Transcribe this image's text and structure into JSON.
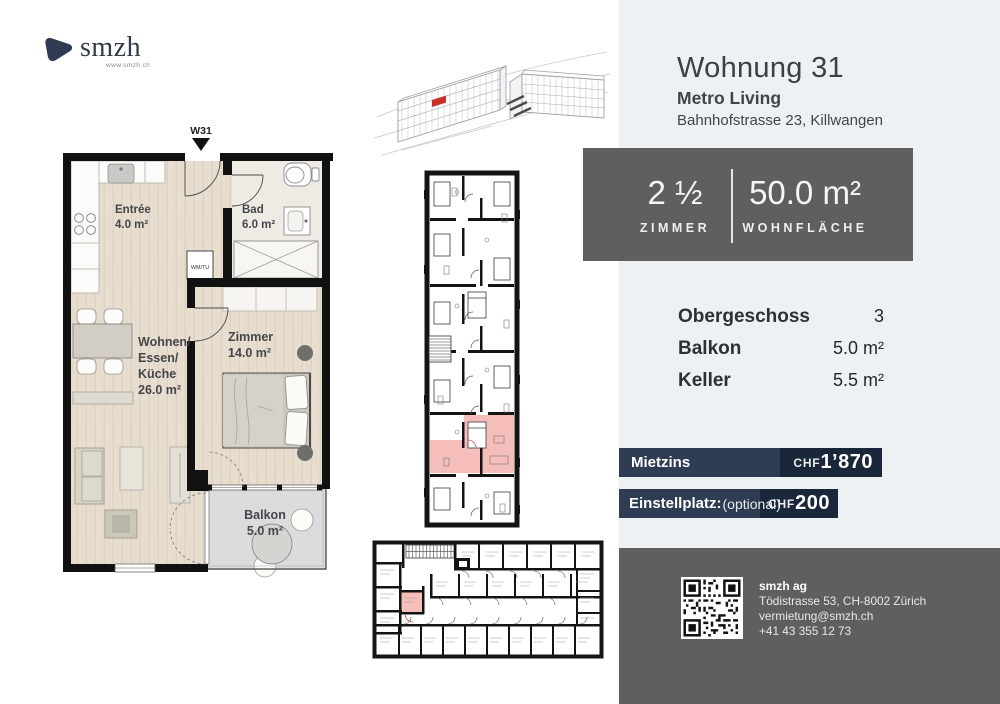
{
  "brand": {
    "name": "smzh",
    "url": "www.smzh.ch"
  },
  "header": {
    "title": "Wohnung 31",
    "project": "Metro Living",
    "address": "Bahnhofstrasse 23, Killwangen"
  },
  "stats": {
    "rooms_value": "2 ½",
    "rooms_label": "ZIMMER",
    "area_value": "50.0 m²",
    "area_label": "WOHNFLÄCHE"
  },
  "details": {
    "rows": [
      {
        "label": "Obergeschoss",
        "value": "3"
      },
      {
        "label": "Balkon",
        "value": "5.0 m²"
      },
      {
        "label": "Keller",
        "value": "5.5 m²"
      }
    ]
  },
  "pricing": {
    "rows": [
      {
        "label": "Mietzins",
        "suffix": "",
        "currency": "CHF",
        "amount": "1’870"
      },
      {
        "label": "Einstellplatz:",
        "suffix": "(optional)",
        "currency": "CHF",
        "amount": "200"
      }
    ]
  },
  "contact": {
    "company": "smzh ag",
    "address": "Tödistrasse 53, CH-8002 Zürich",
    "email": "vermietung@smzh.ch",
    "phone": "+41 43 355 12 73"
  },
  "floorplan": {
    "marker": "W31",
    "marker_arrow_icon": "down-triangle",
    "appliance": "WM/TU",
    "rooms": {
      "entree": {
        "name": "Entrée",
        "area": "4.0 m²"
      },
      "bad": {
        "name": "Bad",
        "area": "6.0 m²"
      },
      "wohnen": {
        "line1": "Wohnen/",
        "line2": "Essen/",
        "line3": "Küche",
        "area": "26.0 m²"
      },
      "zimmer": {
        "name": "Zimmer",
        "area": "14.0 m²"
      },
      "balkon": {
        "name": "Balkon",
        "area": "5.0 m²"
      }
    }
  },
  "colors": {
    "panel": "#eef1f4",
    "box_gray": "#5f5f5f",
    "navy_dark": "#1a2639",
    "navy_light": "#2e3d54",
    "highlight_red": "#cb2f2a",
    "highlight_pink": "#f5beba"
  }
}
